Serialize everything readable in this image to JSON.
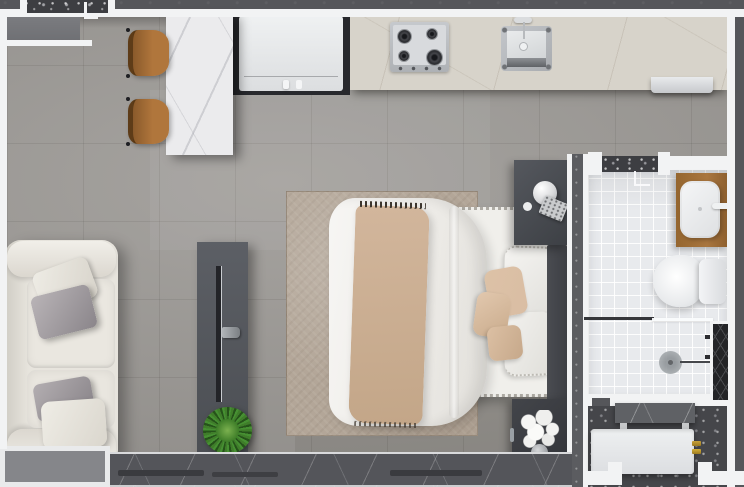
{
  "scene": {
    "title": "Studio apartment floor plan — top-down 3D render",
    "rooms": {
      "main": "Living / bedroom / kitchen open space",
      "bathroom": "Bathroom with shower, toilet and vanity",
      "laundry": "Laundry / service area"
    },
    "features": {
      "entry_door": "Entry door with swing symbol, top-left",
      "bathroom_door": "Bathroom door with terrazzo threshold",
      "window_sill": "Full-width window sill with dark stone track, bottom",
      "balcony_corner": "White parapet corner, bottom-left",
      "service_shaft": "Cross-braced service shaft in right wall",
      "shower_screen": "Glass shower screen",
      "laundry_openings": "Two openings in bottom laundry wall"
    },
    "furniture": {
      "sofa": "Cream fabric sofa with two gray and two cream cushions",
      "tv_console": "Dark gray TV console with mounted flat TV",
      "plant": "Round green potted plant on console",
      "rug": "Distressed taupe area rug",
      "bed": "Double bed with white duvet and pom-pom trim",
      "throw": "Striped beige throw blanket",
      "headboard": "Dark upholstered headboard",
      "nightstand_lamp": "Nightstand with white globe lamp and speckled book",
      "nightstand_flowers": "Nightstand with white flower bouquet in gray vase",
      "dining_table": "White marble dining table",
      "chair_1": "Wooden dining chair (upper)",
      "chair_2": "Wooden dining chair (lower)",
      "fridge": "Built-in refrigerator in dark niche",
      "cooktop": "Four-burner gas cooktop with control knobs",
      "sink": "Stainless kitchen sink with faucet and sprayer",
      "range_hood": "Light appliance mounted below counter edge",
      "counter": "Beige stone kitchen counter along top wall",
      "vanity": "Wood vanity with white rectangular basin and faucet",
      "toilet": "Toilet with cistern",
      "shower_drain": "Round shower drain with wall-mounted arm and valves",
      "utility_counter": "Dark stone utility counter on light legs",
      "washer": "White appliance with two brass valves"
    },
    "colors": {
      "exterior_wall": "#55565a",
      "wall_line": "#f2f3f4",
      "floor_tile": "#9c9995",
      "terrazzo": "#3d3e42",
      "kitchen_counter": "#d7d3ca",
      "table_marble": "#ebebed",
      "chair_wood": "#b0763c",
      "vanity_wood": "#a9763f",
      "sofa_cream": "#e7e4dd",
      "rug_taupe": "#b3a698",
      "bed_white": "#f0efeb",
      "throw_beige": "#d2b69c",
      "pillow_beige": "#d9bda3",
      "bathroom_tile": "#e8eaed",
      "laundry_floor": "#45464a",
      "plant_green": "#3a7a26",
      "brass": "#c9a23a",
      "appliance_white": "#eef0f1",
      "stone_sill": "#54555a"
    }
  }
}
